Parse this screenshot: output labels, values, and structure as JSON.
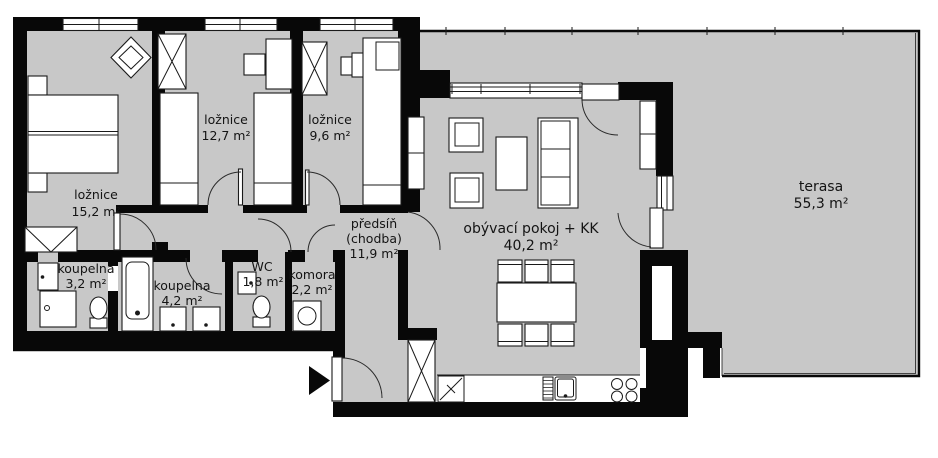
{
  "plan": {
    "type": "apartment-floor-plan",
    "language": "cs",
    "rooms": {
      "loznice_1": {
        "name": "ložnice",
        "area": "15,2 m²"
      },
      "loznice_2": {
        "name": "ložnice",
        "area": "12,7 m²"
      },
      "loznice_3": {
        "name": "ložnice",
        "area": "9,6 m²"
      },
      "koupelna_1": {
        "name": "koupelna",
        "area": "3,2 m²"
      },
      "koupelna_2": {
        "name": "koupelna",
        "area": "4,2 m²"
      },
      "wc": {
        "name": "WC",
        "area": "1,8 m²"
      },
      "komora": {
        "name": "komora",
        "area": "2,2 m²"
      },
      "predsin": {
        "name": "předsíň",
        "alt": "(chodba)",
        "area": "11,9 m²"
      },
      "obyvaci": {
        "name": "obývací pokoj + KK",
        "area": "40,2 m²"
      },
      "terasa": {
        "name": "terasa",
        "area": "55,3 m²"
      }
    }
  },
  "colors": {
    "floor": "#c8c8c8",
    "wall": "#080808",
    "line": "#1a1a1a"
  }
}
